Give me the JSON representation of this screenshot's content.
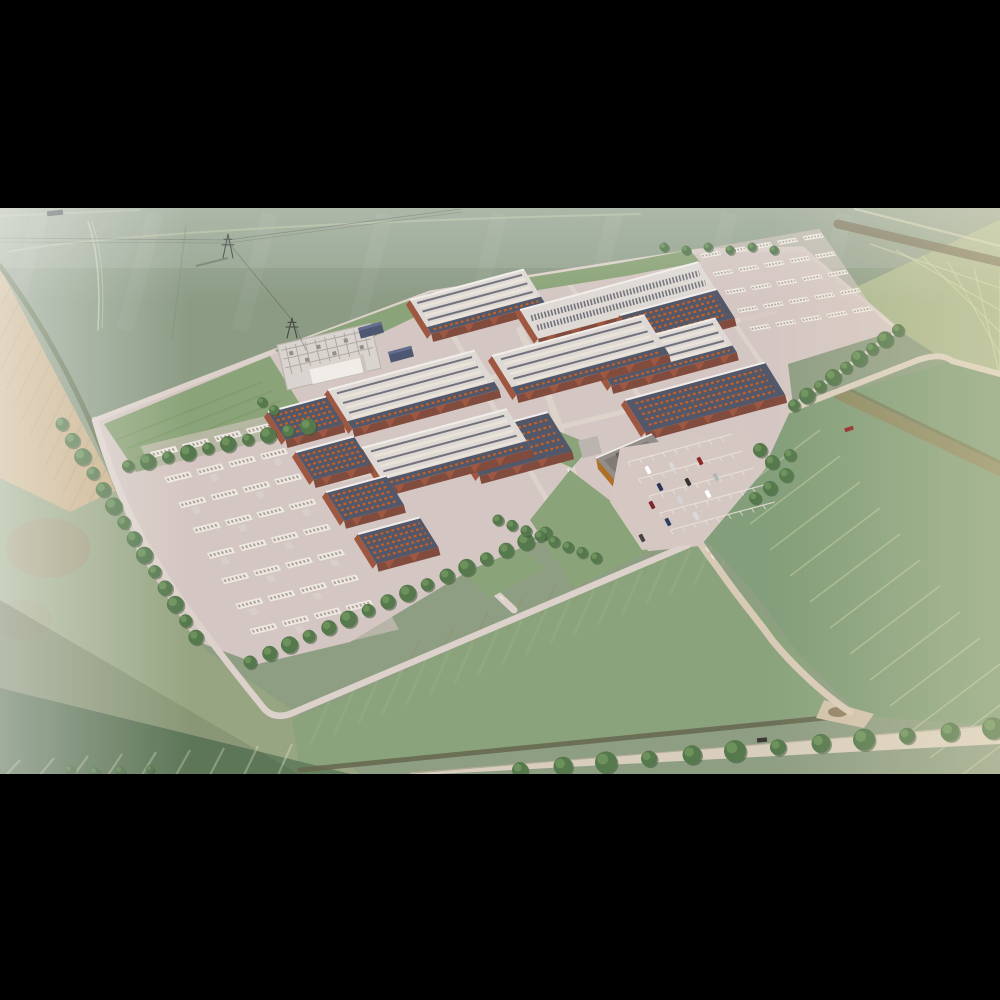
{
  "scene": {
    "title": "Aerial rendering of a hyperscale data center campus surrounded by farmland",
    "time_of_day": "hazy daylight",
    "letterbox_color": "#000000",
    "objects": [
      "black letterbox bars",
      "green arable fields",
      "plowed tan field",
      "electrical substation",
      "power pylons and overhead lines",
      "data hall buildings with rooftop cooling rows",
      "brick facade walls",
      "generator yards with rows of white units",
      "perimeter ring road",
      "tree shelter belts",
      "orange office building",
      "car parking lot with cars",
      "winding access road",
      "country road with tree line",
      "field tramlines"
    ],
    "counts": {
      "data_halls": 13,
      "generator_yards": 2,
      "pylons": 3,
      "parked_cars": 12,
      "small_sheds": 4
    },
    "colors": {
      "field_base": "#8a9a7e",
      "field_top": "#87977f",
      "field_top_light": "#aab59a",
      "field_tan": "#c7ae85",
      "field_tan_line": "#b1976e",
      "field_left": "#93a27d",
      "field_bottom": "#85a077",
      "field_bottom_dark": "#5e7a58",
      "field_se": "#7e9a74",
      "field_yellow": "#aeb98c",
      "stripe_light": "#ccd4a6",
      "hedge": "#5f6e4d",
      "dirt": "#8d7c52",
      "ditch": "#5e6044",
      "road": "#d8cdbb",
      "road_edge": "#b9ad97",
      "pad": "#d3c5c0",
      "ring_road": "#ddd1ca",
      "alley": "#ddd2ca",
      "roof_light": "#ded9d3",
      "roof_stripe_dark": "#6c6c76",
      "roof_stripe_light": "#e9e3d9",
      "roof_navy": "#4a5063",
      "orange_equipment": "#c2591c",
      "brick": "#9a5138",
      "brick_dark": "#7c4334",
      "parapet": "#f2eeea",
      "substation_pad": "#d8d3ce",
      "substation_detail": "#a8a29a",
      "white_building": "#f1ede8",
      "shed_navy": "#46506b",
      "office_orange": "#d8912c",
      "office_orange_dark": "#a96a1e",
      "office_roof": "#8f8a84",
      "parking": "#d4c7c1",
      "parking_line": "#ece2da",
      "grass_inner": "#86a072",
      "tree": "#4e7245",
      "tree_light": "#6d9458",
      "tree_dark": "#33502f",
      "yard_unit": "#efe9e2",
      "yard_unit_detail": "#a9a193",
      "wire": "#55584e",
      "pylon": "#3c423c",
      "car_colors": [
        "#ffffff",
        "#d8d8d8",
        "#8a1f1f",
        "#1f2d4d",
        "#2a2a2a",
        "#b0b6ba",
        "#7a1d24",
        "#cfd3d6",
        "#ffffff",
        "#23365c",
        "#d9d9d9",
        "#3a3a3a"
      ]
    }
  }
}
